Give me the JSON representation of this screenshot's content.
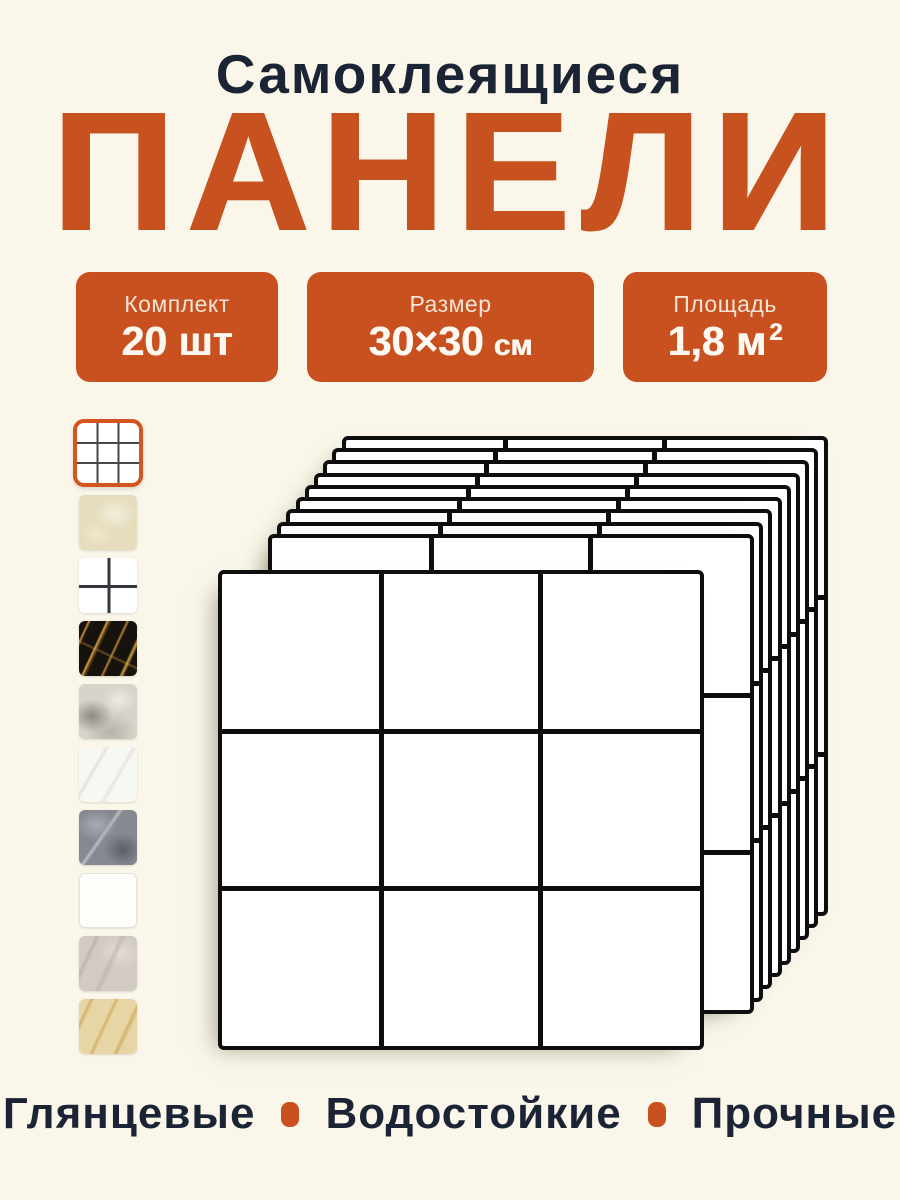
{
  "page": {
    "background_color": "#FAF7EA",
    "accent_color": "#C8521F",
    "text_color": "#1B2434"
  },
  "header": {
    "subtitle": "Самоклеящиеся",
    "title": "ПАНЕЛИ"
  },
  "badges": [
    {
      "label": "Комплект",
      "value": "20 шт",
      "unit": "",
      "sup": ""
    },
    {
      "label": "Размер",
      "value": "30×30",
      "unit": "см",
      "sup": ""
    },
    {
      "label": "Площадь",
      "value": "1,8 м",
      "unit": "",
      "sup": "2"
    }
  ],
  "gallery": {
    "thumbnails": [
      {
        "name": "white-grid-3x3",
        "selected": true
      },
      {
        "name": "beige-marble",
        "selected": false
      },
      {
        "name": "white-grid-2x2",
        "selected": false
      },
      {
        "name": "black-gold-marble",
        "selected": false
      },
      {
        "name": "grey-white-marble",
        "selected": false
      },
      {
        "name": "white-marble",
        "selected": false
      },
      {
        "name": "dark-grey-marble",
        "selected": false
      },
      {
        "name": "plain-white",
        "selected": false
      },
      {
        "name": "light-grey-marble",
        "selected": false
      },
      {
        "name": "beige-gold-marble",
        "selected": false
      }
    ]
  },
  "product_stack": {
    "panel_count": 10,
    "tiles_per_panel": "3×3"
  },
  "features": {
    "items": [
      "Глянцевые",
      "Водостойкие",
      "Прочные"
    ]
  }
}
